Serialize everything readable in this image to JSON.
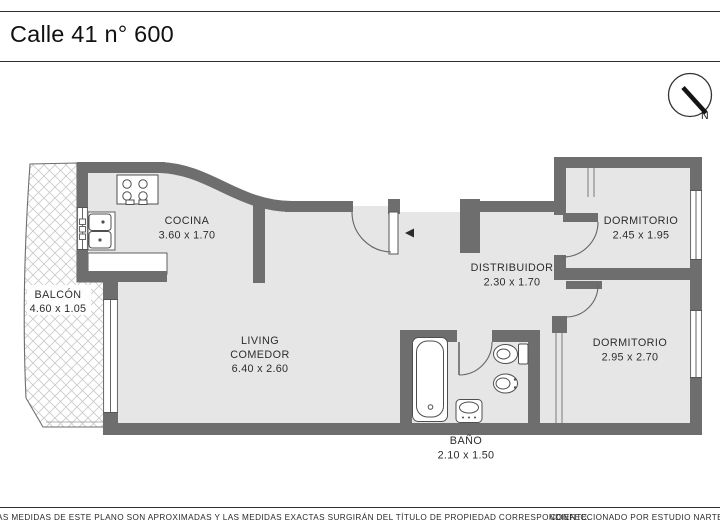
{
  "title": "Calle 41 n° 600",
  "compass": {
    "label": "N"
  },
  "rooms": {
    "cocina": {
      "name": "COCINA",
      "dims": "3.60 x 1.70"
    },
    "balcon": {
      "name": "BALCÓN",
      "dims": "4.60 x 1.05"
    },
    "living": {
      "line1": "LIVING",
      "line2": "COMEDOR",
      "dims": "6.40 x 2.60"
    },
    "distribuidor": {
      "name": "DISTRIBUIDOR",
      "dims": "2.30 x 1.70"
    },
    "dormitorio_1": {
      "name": "DORMITORIO",
      "dims": "2.45 x 1.95"
    },
    "dormitorio_2": {
      "name": "DORMITORIO",
      "dims": "2.95 x 2.70"
    },
    "bano": {
      "name": "BAÑO",
      "dims": "2.10 x 1.50"
    }
  },
  "footer": {
    "disclaimer": "AS MEDIDAS  DE ESTE PLANO SON APROXIMADAS Y LAS MEDIDAS EXACTAS SURGIRÁN DEL TÍTULO DE PROPIEDAD CORRESPONDIENTE.",
    "credit": "CONFECCIONADO POR ESTUDIO NARTE"
  },
  "colors": {
    "wall": "#6e6e6e",
    "floor": "#e6e6e6",
    "hatch_line": "#cbcbcb",
    "fixture_line": "#4f4f4f",
    "text": "#2d2d2d"
  }
}
